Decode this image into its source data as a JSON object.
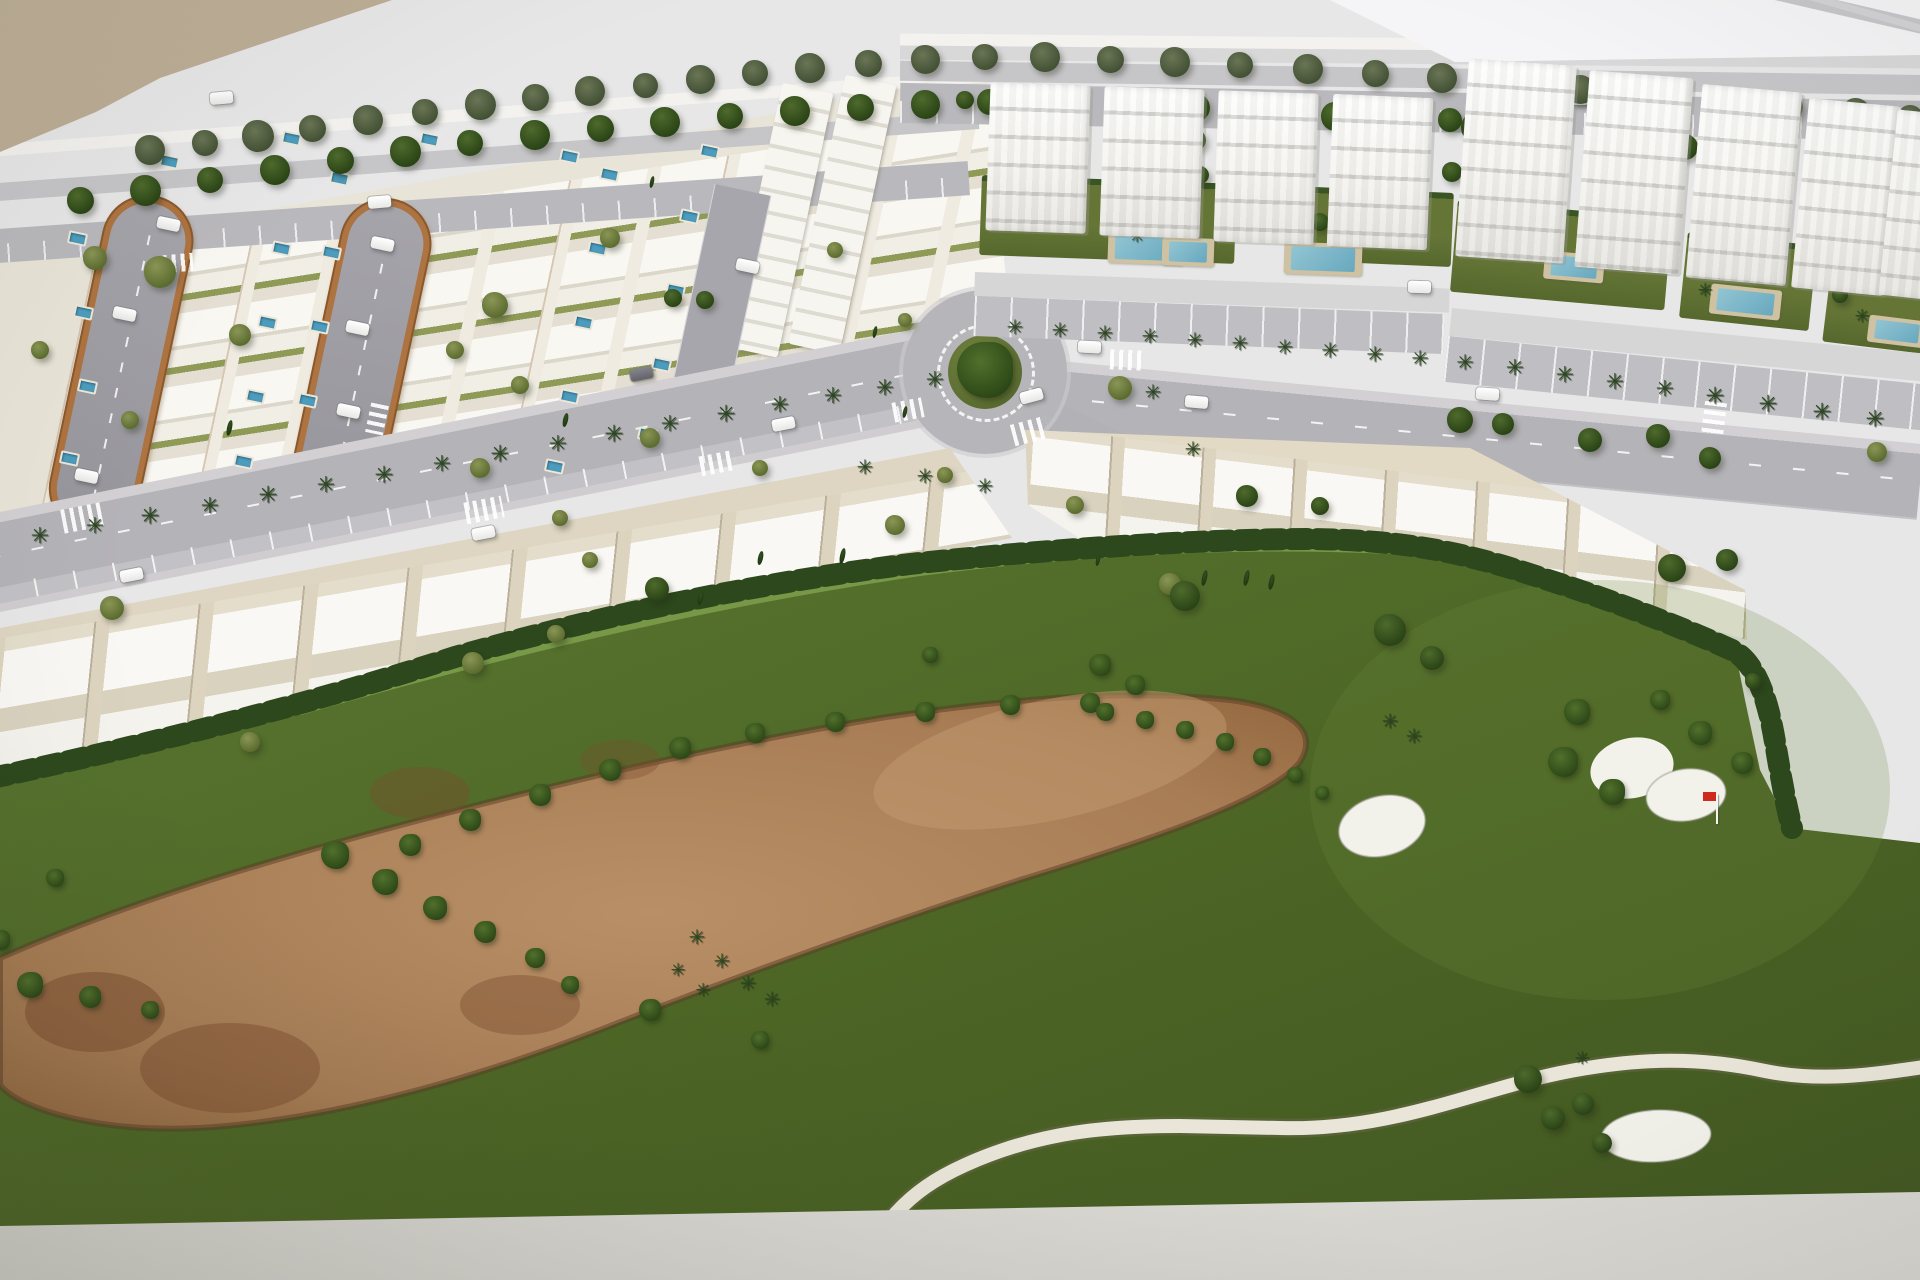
{
  "meta": {
    "title": "Architectural scale model photograph",
    "description": "Aerial photograph of a white architectural maquette of a golf resort development: villa estate with two cul-de-sac loop streets and private pools, rows of white apartment blocks with communal pools, a palm-lined avenue with a roundabout, curved townhouse rows behind a hedge, and a golf course with a sandy waste area, three white bunkers, a cart path and a red pin flag on a white display base."
  },
  "palette": {
    "background": "#e7e7e8",
    "bright_background": "#f5f5f7",
    "beige_corner": "#b3a48c",
    "board": "#d3d0cb",
    "road": "#b4b3b8",
    "villa_ground": "#e9e4d8",
    "terracotta": "#ad7340",
    "building_white": "#f8f6f1",
    "garden_green": "#647536",
    "pool_blue": "#4d9cbd",
    "apartment_pool": "#7db6c9",
    "grass": "#50682c",
    "hedge": "#2c481c",
    "dirt": "#ab8058",
    "bunker": "#f2f1ea",
    "cart_path": "#e9e5d9",
    "flag_red": "#ce2b1f",
    "base_front": "#eceae6"
  },
  "glyphs": {
    "palm": "✳"
  },
  "scene": {
    "crosswalks": [
      [
        62,
        506,
        -11,
        40,
        24
      ],
      [
        465,
        499,
        -11,
        38,
        22
      ],
      [
        700,
        453,
        -11,
        36,
        20
      ],
      [
        893,
        400,
        -11,
        30,
        20
      ],
      [
        1012,
        420,
        -15,
        36,
        22
      ],
      [
        1110,
        350,
        2,
        34,
        20
      ],
      [
        1697,
        408,
        97,
        34,
        22
      ],
      [
        362,
        410,
        102,
        30,
        18
      ],
      [
        163,
        254,
        -5,
        30,
        18
      ]
    ],
    "villa_pools": [
      [
        160,
        155
      ],
      [
        282,
        132
      ],
      [
        420,
        133
      ],
      [
        560,
        150
      ],
      [
        700,
        145
      ],
      [
        68,
        232
      ],
      [
        74,
        306
      ],
      [
        78,
        380
      ],
      [
        60,
        452
      ],
      [
        268,
        168
      ],
      [
        272,
        242
      ],
      [
        258,
        316
      ],
      [
        246,
        390
      ],
      [
        234,
        455
      ],
      [
        330,
        172
      ],
      [
        322,
        246
      ],
      [
        310,
        320
      ],
      [
        298,
        394
      ],
      [
        600,
        168
      ],
      [
        588,
        242
      ],
      [
        574,
        316
      ],
      [
        560,
        390
      ],
      [
        545,
        460
      ],
      [
        680,
        210
      ],
      [
        666,
        284
      ],
      [
        652,
        358
      ],
      [
        638,
        428
      ]
    ],
    "apt_pools": [
      [
        1108,
        230,
        60,
        22,
        2
      ],
      [
        1162,
        238,
        36,
        16,
        2
      ],
      [
        1284,
        243,
        62,
        20,
        2
      ],
      [
        1544,
        253,
        44,
        16,
        5
      ],
      [
        1710,
        287,
        55,
        18,
        6
      ],
      [
        1868,
        318,
        42,
        15,
        7
      ]
    ],
    "cars": [
      [
        157,
        218,
        12,
        "w"
      ],
      [
        113,
        308,
        12,
        "w"
      ],
      [
        75,
        470,
        12,
        "w"
      ],
      [
        371,
        238,
        12,
        "w"
      ],
      [
        346,
        322,
        12,
        "w"
      ],
      [
        337,
        405,
        12,
        "w"
      ],
      [
        120,
        569,
        -11,
        "w"
      ],
      [
        472,
        527,
        -11,
        "w"
      ],
      [
        772,
        418,
        -11,
        "w"
      ],
      [
        1020,
        390,
        -15,
        "w"
      ],
      [
        1185,
        396,
        5,
        "w"
      ],
      [
        1476,
        388,
        4,
        "w"
      ],
      [
        368,
        196,
        -5,
        "w"
      ],
      [
        1565,
        93,
        1,
        "w"
      ],
      [
        1408,
        281,
        2,
        "w"
      ],
      [
        630,
        368,
        -11,
        "g"
      ],
      [
        1078,
        341,
        3,
        "w"
      ],
      [
        736,
        260,
        12,
        "w"
      ],
      [
        210,
        92,
        -5,
        "w"
      ]
    ],
    "trees": [
      [
        150,
        150,
        30,
        2
      ],
      [
        205,
        143,
        26,
        2
      ],
      [
        258,
        136,
        32,
        2
      ],
      [
        312,
        128,
        27,
        2
      ],
      [
        368,
        120,
        30,
        2
      ],
      [
        425,
        112,
        26,
        2
      ],
      [
        480,
        104,
        31,
        2
      ],
      [
        535,
        97,
        27,
        2
      ],
      [
        590,
        91,
        30,
        2
      ],
      [
        645,
        85,
        25,
        2
      ],
      [
        700,
        79,
        29,
        2
      ],
      [
        755,
        73,
        26,
        2
      ],
      [
        810,
        68,
        30,
        2
      ],
      [
        868,
        63,
        27,
        2
      ],
      [
        925,
        59,
        29,
        2
      ],
      [
        985,
        57,
        26,
        2
      ],
      [
        1045,
        57,
        30,
        2
      ],
      [
        1110,
        59,
        27,
        2
      ],
      [
        1175,
        62,
        30,
        2
      ],
      [
        1240,
        65,
        26,
        2
      ],
      [
        1308,
        69,
        30,
        2
      ],
      [
        1375,
        73,
        27,
        2
      ],
      [
        1442,
        78,
        30,
        2
      ],
      [
        1510,
        83,
        26,
        2
      ],
      [
        1580,
        89,
        29,
        2
      ],
      [
        1650,
        95,
        27,
        2
      ],
      [
        1720,
        101,
        30,
        2
      ],
      [
        1790,
        107,
        26,
        2
      ],
      [
        1856,
        112,
        28,
        2
      ],
      [
        1910,
        117,
        25,
        2
      ],
      [
        80,
        200,
        27,
        0
      ],
      [
        145,
        190,
        31,
        0
      ],
      [
        210,
        180,
        26,
        0
      ],
      [
        275,
        170,
        30,
        0
      ],
      [
        340,
        160,
        27,
        0
      ],
      [
        405,
        151,
        31,
        0
      ],
      [
        470,
        143,
        26,
        0
      ],
      [
        535,
        135,
        30,
        0
      ],
      [
        600,
        128,
        27,
        0
      ],
      [
        665,
        122,
        30,
        0
      ],
      [
        730,
        116,
        26,
        0
      ],
      [
        795,
        111,
        30,
        0
      ],
      [
        860,
        107,
        27,
        0
      ],
      [
        925,
        104,
        29,
        0
      ],
      [
        990,
        102,
        26,
        0
      ],
      [
        1055,
        102,
        29,
        0
      ],
      [
        1125,
        104,
        26,
        0
      ],
      [
        1195,
        107,
        29,
        0
      ],
      [
        1265,
        111,
        26,
        0
      ],
      [
        1335,
        116,
        29,
        0
      ],
      [
        1405,
        121,
        26,
        0
      ],
      [
        1475,
        127,
        29,
        0
      ],
      [
        1545,
        133,
        26,
        0
      ],
      [
        1615,
        140,
        28,
        0
      ],
      [
        1685,
        147,
        26,
        0
      ],
      [
        1755,
        154,
        28,
        0
      ],
      [
        1825,
        161,
        25,
        0
      ],
      [
        1890,
        168,
        27,
        0
      ],
      [
        160,
        272,
        32,
        1
      ],
      [
        95,
        258,
        24,
        1
      ],
      [
        240,
        335,
        22,
        1
      ],
      [
        495,
        305,
        26,
        1
      ],
      [
        520,
        385,
        18,
        1
      ],
      [
        455,
        350,
        18,
        1
      ],
      [
        610,
        238,
        20,
        1
      ],
      [
        650,
        438,
        20,
        1
      ],
      [
        480,
        468,
        20,
        1
      ],
      [
        560,
        518,
        16,
        1
      ],
      [
        705,
        300,
        18,
        0
      ],
      [
        673,
        298,
        18,
        0
      ],
      [
        760,
        468,
        16,
        1
      ],
      [
        130,
        420,
        18,
        1
      ],
      [
        40,
        350,
        18,
        1
      ],
      [
        590,
        560,
        16,
        1
      ],
      [
        835,
        250,
        16,
        1
      ],
      [
        905,
        320,
        14,
        1
      ],
      [
        112,
        608,
        24,
        1
      ],
      [
        250,
        742,
        20,
        1
      ],
      [
        473,
        663,
        22,
        1
      ],
      [
        556,
        634,
        18,
        1
      ],
      [
        657,
        589,
        24,
        0
      ],
      [
        895,
        525,
        20,
        1
      ],
      [
        1170,
        584,
        22,
        1
      ],
      [
        1247,
        496,
        22,
        0
      ],
      [
        1320,
        506,
        18,
        0
      ],
      [
        1120,
        388,
        24,
        1
      ],
      [
        1075,
        505,
        18,
        1
      ],
      [
        945,
        475,
        16,
        1
      ],
      [
        1390,
        630,
        32,
        0
      ],
      [
        1432,
        658,
        24,
        0
      ],
      [
        965,
        100,
        18,
        0
      ],
      [
        1000,
        150,
        18,
        0
      ],
      [
        1185,
        596,
        30,
        0
      ],
      [
        1528,
        1079,
        28,
        0
      ],
      [
        1553,
        1118,
        24,
        0
      ],
      [
        1583,
        1104,
        22,
        0
      ],
      [
        1602,
        1143,
        20,
        0
      ],
      [
        1753,
        681,
        16,
        0
      ]
    ],
    "fg_trees": [
      [
        1195,
        140,
        22,
        0
      ],
      [
        1200,
        175,
        18,
        0
      ],
      [
        1450,
        120,
        24,
        0
      ],
      [
        1452,
        172,
        20,
        0
      ],
      [
        1060,
        205,
        16,
        0
      ],
      [
        1135,
        213,
        18,
        0
      ],
      [
        1240,
        213,
        16,
        0
      ],
      [
        1320,
        222,
        18,
        0
      ],
      [
        1520,
        230,
        18,
        0
      ],
      [
        1600,
        250,
        16,
        0
      ],
      [
        1760,
        272,
        18,
        0
      ],
      [
        1840,
        295,
        16,
        0
      ],
      [
        1877,
        452,
        20,
        1
      ],
      [
        1460,
        420,
        26,
        0
      ],
      [
        1503,
        424,
        22,
        0
      ],
      [
        1590,
        440,
        24,
        0
      ],
      [
        1658,
        436,
        24,
        0
      ],
      [
        1710,
        458,
        22,
        0
      ],
      [
        1672,
        568,
        28,
        0
      ],
      [
        1727,
        560,
        22,
        0
      ]
    ],
    "bushes": [
      [
        410,
        845,
        22
      ],
      [
        470,
        820,
        22
      ],
      [
        540,
        795,
        22
      ],
      [
        610,
        770,
        22
      ],
      [
        680,
        748,
        22
      ],
      [
        755,
        733,
        20
      ],
      [
        835,
        722,
        20
      ],
      [
        925,
        712,
        20
      ],
      [
        1010,
        705,
        20
      ],
      [
        1090,
        703,
        20
      ],
      [
        1105,
        712,
        18
      ],
      [
        1145,
        720,
        18
      ],
      [
        1185,
        730,
        18
      ],
      [
        1225,
        742,
        18
      ],
      [
        1262,
        757,
        18
      ],
      [
        1295,
        775,
        16
      ],
      [
        1322,
        793,
        14
      ],
      [
        335,
        855,
        28
      ],
      [
        385,
        882,
        26
      ],
      [
        435,
        908,
        24
      ],
      [
        485,
        932,
        22
      ],
      [
        535,
        958,
        20
      ],
      [
        570,
        985,
        18
      ],
      [
        650,
        1010,
        22
      ],
      [
        760,
        1040,
        18
      ],
      [
        30,
        985,
        26
      ],
      [
        90,
        997,
        22
      ],
      [
        150,
        1010,
        18
      ],
      [
        55,
        878,
        18
      ],
      [
        0,
        940,
        20
      ],
      [
        1100,
        665,
        22
      ],
      [
        1135,
        685,
        20
      ],
      [
        930,
        655,
        16
      ],
      [
        1577,
        712,
        26
      ],
      [
        1563,
        762,
        30
      ],
      [
        1612,
        792,
        26
      ],
      [
        1700,
        733,
        24
      ],
      [
        1742,
        763,
        22
      ],
      [
        1660,
        700,
        20
      ]
    ],
    "cypresses": [
      [
        230,
        428,
        16
      ],
      [
        565,
        420,
        14
      ],
      [
        843,
        556,
        16
      ],
      [
        760,
        558,
        14
      ],
      [
        1205,
        578,
        16
      ],
      [
        1247,
        578,
        16
      ],
      [
        1272,
        582,
        16
      ],
      [
        905,
        412,
        12
      ],
      [
        652,
        182,
        12
      ],
      [
        875,
        332,
        12
      ],
      [
        1098,
        560,
        12
      ],
      [
        700,
        598,
        14
      ]
    ],
    "palms": [
      [
        40,
        538,
        22
      ],
      [
        95,
        528,
        22
      ],
      [
        150,
        518,
        23
      ],
      [
        210,
        508,
        22
      ],
      [
        268,
        497,
        23
      ],
      [
        326,
        487,
        22
      ],
      [
        384,
        477,
        23
      ],
      [
        442,
        466,
        22
      ],
      [
        500,
        456,
        23
      ],
      [
        558,
        446,
        22
      ],
      [
        614,
        436,
        23
      ],
      [
        670,
        426,
        22
      ],
      [
        726,
        416,
        23
      ],
      [
        780,
        407,
        22
      ],
      [
        833,
        398,
        22
      ],
      [
        885,
        390,
        22
      ],
      [
        935,
        382,
        22
      ],
      [
        1015,
        328,
        20
      ],
      [
        1060,
        331,
        20
      ],
      [
        1105,
        334,
        20
      ],
      [
        1150,
        337,
        20
      ],
      [
        1195,
        341,
        20
      ],
      [
        1240,
        344,
        20
      ],
      [
        1285,
        348,
        20
      ],
      [
        1330,
        352,
        21
      ],
      [
        1375,
        356,
        21
      ],
      [
        1420,
        360,
        21
      ],
      [
        1465,
        364,
        21
      ],
      [
        1515,
        370,
        22
      ],
      [
        1565,
        377,
        22
      ],
      [
        1615,
        384,
        22
      ],
      [
        1665,
        391,
        22
      ],
      [
        1715,
        398,
        23
      ],
      [
        1768,
        406,
        23
      ],
      [
        1822,
        414,
        23
      ],
      [
        1875,
        421,
        23
      ],
      [
        865,
        468,
        20
      ],
      [
        925,
        477,
        20
      ],
      [
        985,
        487,
        20
      ],
      [
        1153,
        393,
        20
      ],
      [
        1193,
        450,
        20
      ],
      [
        1025,
        192,
        18
      ],
      [
        1137,
        238,
        18
      ],
      [
        1305,
        238,
        18
      ],
      [
        1505,
        248,
        18
      ],
      [
        1705,
        292,
        18
      ],
      [
        1862,
        318,
        18
      ],
      [
        1390,
        722,
        20
      ],
      [
        1414,
        737,
        20
      ],
      [
        1582,
        1060,
        18
      ],
      [
        697,
        938,
        20
      ],
      [
        722,
        962,
        20
      ],
      [
        748,
        984,
        20
      ],
      [
        772,
        1000,
        20
      ],
      [
        703,
        992,
        18
      ],
      [
        678,
        972,
        18
      ]
    ],
    "apt_blocks": [
      [
        988,
        84,
        100,
        148,
        2
      ],
      [
        1102,
        88,
        100,
        149,
        2
      ],
      [
        1216,
        92,
        100,
        151,
        2
      ],
      [
        1330,
        96,
        100,
        152,
        2.5
      ],
      [
        1462,
        62,
        108,
        198,
        4
      ],
      [
        1582,
        74,
        104,
        197,
        4.5
      ],
      [
        1694,
        88,
        100,
        194,
        5
      ],
      [
        1800,
        102,
        92,
        190,
        5.5
      ],
      [
        1888,
        112,
        58,
        186,
        6
      ]
    ],
    "flag": {
      "x": 1714,
      "y": 792
    }
  }
}
